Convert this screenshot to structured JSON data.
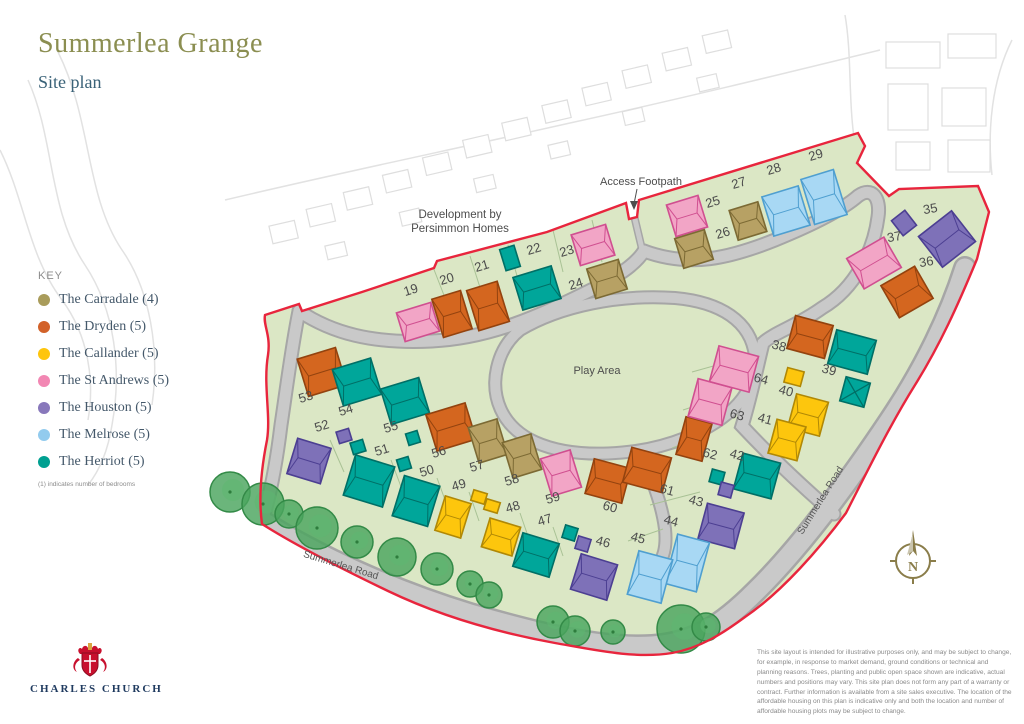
{
  "header": {
    "title": "Summerlea Grange",
    "subtitle": "Site plan"
  },
  "key": {
    "heading": "KEY",
    "note": "(1) indicates number of bedrooms",
    "items": [
      {
        "label": "The Carradale (4)",
        "color": "#a99c5b"
      },
      {
        "label": "The Dryden (5)",
        "color": "#d2622a"
      },
      {
        "label": "The Callander (5)",
        "color": "#fec50d"
      },
      {
        "label": "The St Andrews (5)",
        "color": "#f287b3"
      },
      {
        "label": "The Houston (5)",
        "color": "#8878bb"
      },
      {
        "label": "The Melrose (5)",
        "color": "#92cbee"
      },
      {
        "label": "The Herriot (5)",
        "color": "#00a091"
      }
    ]
  },
  "footer": {
    "logo": "CHARLES CHURCH",
    "disclaimer": "This site layout is intended for illustrative purposes only, and may be subject to change, for example, in response to market demand, ground conditions or technical and planning reasons. Trees, planting and public open space shown are indicative, actual numbers and positions may vary. This site plan does not form any part of a warranty or contract. Further information is available from a site sales executive. The location of the affordable housing on this plan is indicative only and both the location and number of affordable housing plots may be subject to change."
  },
  "map": {
    "labels": {
      "persimmon_line1": "Development by",
      "persimmon_line2": "Persimmon Homes",
      "access_footpath": "Access Footpath",
      "play_area": "Play Area",
      "road_bottom": "Summerlea Road",
      "road_right": "Summerlea Road"
    },
    "compass_n": "N",
    "boundary_color": "#e8253d",
    "site_green": "#dbe7c5",
    "house_colors": {
      "carradale": {
        "f": "#b7a164",
        "s": "#7c6a34"
      },
      "dryden": {
        "f": "#d4661f",
        "s": "#93430f"
      },
      "callander": {
        "f": "#fdc60d",
        "s": "#b08806"
      },
      "standrews": {
        "f": "#f2a5c6",
        "s": "#d04f90"
      },
      "houston": {
        "f": "#7e71b8",
        "s": "#4c3f92"
      },
      "melrose": {
        "f": "#a8d8f4",
        "s": "#4f9fd0"
      },
      "herriot": {
        "f": "#00a69a",
        "s": "#006f66"
      }
    },
    "plots": [
      {
        "n": "19",
        "x": 412,
        "y": 294,
        "r": -17
      },
      {
        "n": "20",
        "x": 448,
        "y": 283,
        "r": -17
      },
      {
        "n": "21",
        "x": 483,
        "y": 270,
        "r": -17
      },
      {
        "n": "22",
        "x": 535,
        "y": 253,
        "r": -17
      },
      {
        "n": "23",
        "x": 568,
        "y": 255,
        "r": -17
      },
      {
        "n": "24",
        "x": 577,
        "y": 288,
        "r": -17
      },
      {
        "n": "25",
        "x": 714,
        "y": 206,
        "r": -17
      },
      {
        "n": "26",
        "x": 724,
        "y": 237,
        "r": -17
      },
      {
        "n": "27",
        "x": 740,
        "y": 187,
        "r": -17
      },
      {
        "n": "28",
        "x": 775,
        "y": 173,
        "r": -17
      },
      {
        "n": "29",
        "x": 817,
        "y": 159,
        "r": -17
      },
      {
        "n": "35",
        "x": 931,
        "y": 213,
        "r": -10
      },
      {
        "n": "36",
        "x": 927,
        "y": 266,
        "r": -10
      },
      {
        "n": "37",
        "x": 895,
        "y": 241,
        "r": -10
      },
      {
        "n": "38",
        "x": 778,
        "y": 350,
        "r": 15
      },
      {
        "n": "39",
        "x": 828,
        "y": 374,
        "r": 15
      },
      {
        "n": "40",
        "x": 785,
        "y": 395,
        "r": 15
      },
      {
        "n": "41",
        "x": 764,
        "y": 423,
        "r": 15
      },
      {
        "n": "42",
        "x": 736,
        "y": 459,
        "r": 15
      },
      {
        "n": "43",
        "x": 695,
        "y": 505,
        "r": 15
      },
      {
        "n": "44",
        "x": 670,
        "y": 525,
        "r": 15
      },
      {
        "n": "45",
        "x": 637,
        "y": 542,
        "r": 15
      },
      {
        "n": "46",
        "x": 602,
        "y": 546,
        "r": 15
      },
      {
        "n": "47",
        "x": 546,
        "y": 524,
        "r": -17
      },
      {
        "n": "48",
        "x": 514,
        "y": 511,
        "r": -17
      },
      {
        "n": "49",
        "x": 460,
        "y": 489,
        "r": -17
      },
      {
        "n": "50",
        "x": 428,
        "y": 475,
        "r": -17
      },
      {
        "n": "51",
        "x": 383,
        "y": 454,
        "r": -17
      },
      {
        "n": "52",
        "x": 323,
        "y": 430,
        "r": -17
      },
      {
        "n": "53",
        "x": 307,
        "y": 401,
        "r": -17
      },
      {
        "n": "54",
        "x": 347,
        "y": 414,
        "r": -17
      },
      {
        "n": "55",
        "x": 392,
        "y": 431,
        "r": -17
      },
      {
        "n": "56",
        "x": 440,
        "y": 456,
        "r": -17
      },
      {
        "n": "57",
        "x": 478,
        "y": 470,
        "r": -17
      },
      {
        "n": "58",
        "x": 513,
        "y": 484,
        "r": -17
      },
      {
        "n": "59",
        "x": 554,
        "y": 502,
        "r": -17
      },
      {
        "n": "60",
        "x": 609,
        "y": 511,
        "r": 15
      },
      {
        "n": "61",
        "x": 666,
        "y": 494,
        "r": 15
      },
      {
        "n": "62",
        "x": 709,
        "y": 458,
        "r": 15
      },
      {
        "n": "63",
        "x": 736,
        "y": 419,
        "r": 15
      },
      {
        "n": "64",
        "x": 760,
        "y": 383,
        "r": 15
      }
    ],
    "houses": [
      {
        "t": "standrews",
        "x": 418,
        "y": 322,
        "w": 36,
        "h": 30,
        "r": -17
      },
      {
        "t": "dryden",
        "x": 452,
        "y": 314,
        "w": 30,
        "h": 40,
        "r": -17
      },
      {
        "t": "dryden",
        "x": 488,
        "y": 306,
        "w": 32,
        "h": 42,
        "r": -17
      },
      {
        "t": "herriot",
        "x": 537,
        "y": 288,
        "w": 40,
        "h": 34,
        "r": -17
      },
      {
        "t": "standrews",
        "x": 593,
        "y": 245,
        "w": 36,
        "h": 32,
        "r": -17
      },
      {
        "t": "carradale",
        "x": 607,
        "y": 279,
        "w": 33,
        "h": 31,
        "r": -17
      },
      {
        "t": "standrews",
        "x": 687,
        "y": 216,
        "w": 33,
        "h": 33,
        "r": -17
      },
      {
        "t": "carradale",
        "x": 694,
        "y": 249,
        "w": 31,
        "h": 31,
        "r": -17
      },
      {
        "t": "carradale",
        "x": 748,
        "y": 221,
        "w": 30,
        "h": 31,
        "r": -17
      },
      {
        "t": "melrose",
        "x": 786,
        "y": 211,
        "w": 38,
        "h": 41,
        "r": -17
      },
      {
        "t": "melrose",
        "x": 824,
        "y": 197,
        "w": 34,
        "h": 47,
        "r": -17
      },
      {
        "t": "houston",
        "x": 947,
        "y": 239,
        "w": 42,
        "h": 39,
        "r": -38
      },
      {
        "t": "dryden",
        "x": 907,
        "y": 292,
        "w": 39,
        "h": 37,
        "r": -30
      },
      {
        "t": "standrews",
        "x": 874,
        "y": 263,
        "w": 43,
        "h": 35,
        "r": -30
      },
      {
        "t": "dryden",
        "x": 810,
        "y": 337,
        "w": 39,
        "h": 34,
        "r": 15
      },
      {
        "t": "herriot",
        "x": 852,
        "y": 352,
        "w": 41,
        "h": 35,
        "r": 15
      },
      {
        "t": "callander",
        "x": 808,
        "y": 415,
        "w": 33,
        "h": 35,
        "r": 15
      },
      {
        "t": "callander",
        "x": 787,
        "y": 440,
        "w": 30,
        "h": 35,
        "r": 15
      },
      {
        "t": "herriot",
        "x": 757,
        "y": 476,
        "w": 39,
        "h": 37,
        "r": 15
      },
      {
        "t": "houston",
        "x": 721,
        "y": 526,
        "w": 38,
        "h": 37,
        "r": 15
      },
      {
        "t": "melrose",
        "x": 687,
        "y": 563,
        "w": 33,
        "h": 51,
        "r": 15
      },
      {
        "t": "melrose",
        "x": 650,
        "y": 577,
        "w": 35,
        "h": 45,
        "r": 15
      },
      {
        "t": "houston",
        "x": 594,
        "y": 577,
        "w": 38,
        "h": 37,
        "r": 17
      },
      {
        "t": "herriot",
        "x": 536,
        "y": 555,
        "w": 38,
        "h": 35,
        "r": 17
      },
      {
        "t": "callander",
        "x": 501,
        "y": 537,
        "w": 32,
        "h": 30,
        "r": 17
      },
      {
        "t": "callander",
        "x": 453,
        "y": 517,
        "w": 27,
        "h": 36,
        "r": 17
      },
      {
        "t": "herriot",
        "x": 416,
        "y": 501,
        "w": 37,
        "h": 42,
        "r": 17
      },
      {
        "t": "herriot",
        "x": 369,
        "y": 481,
        "w": 41,
        "h": 42,
        "r": 17
      },
      {
        "t": "houston",
        "x": 309,
        "y": 461,
        "w": 35,
        "h": 37,
        "r": 17
      },
      {
        "t": "dryden",
        "x": 322,
        "y": 372,
        "w": 40,
        "h": 39,
        "r": -17
      },
      {
        "t": "herriot",
        "x": 357,
        "y": 382,
        "w": 40,
        "h": 38,
        "r": -17
      },
      {
        "t": "herriot",
        "x": 405,
        "y": 401,
        "w": 40,
        "h": 37,
        "r": -17
      },
      {
        "t": "dryden",
        "x": 451,
        "y": 427,
        "w": 41,
        "h": 38,
        "r": -17
      },
      {
        "t": "carradale",
        "x": 488,
        "y": 441,
        "w": 30,
        "h": 37,
        "r": -17
      },
      {
        "t": "carradale",
        "x": 522,
        "y": 456,
        "w": 30,
        "h": 37,
        "r": -17
      },
      {
        "t": "standrews",
        "x": 561,
        "y": 473,
        "w": 31,
        "h": 39,
        "r": -17
      },
      {
        "t": "dryden",
        "x": 608,
        "y": 481,
        "w": 38,
        "h": 36,
        "r": 15
      },
      {
        "t": "dryden",
        "x": 647,
        "y": 470,
        "w": 41,
        "h": 36,
        "r": 15
      },
      {
        "t": "dryden",
        "x": 694,
        "y": 439,
        "w": 27,
        "h": 39,
        "r": 15
      },
      {
        "t": "standrews",
        "x": 710,
        "y": 402,
        "w": 35,
        "h": 39,
        "r": 15
      },
      {
        "t": "standrews",
        "x": 734,
        "y": 369,
        "w": 41,
        "h": 37,
        "r": 15
      }
    ],
    "garages": [
      {
        "t": "herriot",
        "x": 510,
        "y": 258,
        "w": 15,
        "h": 22,
        "r": -17
      },
      {
        "t": "houston",
        "x": 904,
        "y": 223,
        "w": 17,
        "h": 19,
        "r": -38
      },
      {
        "t": "callander",
        "x": 794,
        "y": 377,
        "w": 17,
        "h": 15,
        "r": 15
      },
      {
        "t": "herriot",
        "x": 855,
        "y": 392,
        "w": 25,
        "h": 25,
        "r": 15,
        "cross": true
      },
      {
        "t": "herriot",
        "x": 717,
        "y": 477,
        "w": 13,
        "h": 13,
        "r": 15
      },
      {
        "t": "houston",
        "x": 726,
        "y": 490,
        "w": 13,
        "h": 13,
        "r": 15
      },
      {
        "t": "herriot",
        "x": 570,
        "y": 533,
        "w": 13,
        "h": 13,
        "r": 17
      },
      {
        "t": "houston",
        "x": 583,
        "y": 544,
        "w": 13,
        "h": 13,
        "r": 17
      },
      {
        "t": "callander",
        "x": 479,
        "y": 497,
        "w": 14,
        "h": 11,
        "r": 17
      },
      {
        "t": "callander",
        "x": 492,
        "y": 506,
        "w": 14,
        "h": 11,
        "r": 17
      },
      {
        "t": "herriot",
        "x": 413,
        "y": 438,
        "w": 12,
        "h": 12,
        "r": -17
      },
      {
        "t": "herriot",
        "x": 404,
        "y": 464,
        "w": 12,
        "h": 12,
        "r": -17
      },
      {
        "t": "houston",
        "x": 344,
        "y": 436,
        "w": 13,
        "h": 12,
        "r": -17
      },
      {
        "t": "herriot",
        "x": 358,
        "y": 447,
        "w": 13,
        "h": 12,
        "r": -17
      }
    ],
    "trees": [
      [
        230,
        492,
        20
      ],
      [
        263,
        504,
        21
      ],
      [
        289,
        514,
        14
      ],
      [
        317,
        528,
        21
      ],
      [
        357,
        542,
        16
      ],
      [
        397,
        557,
        19
      ],
      [
        437,
        569,
        16
      ],
      [
        470,
        584,
        13
      ],
      [
        489,
        595,
        13
      ],
      [
        553,
        622,
        16
      ],
      [
        575,
        631,
        15
      ],
      [
        613,
        632,
        12
      ],
      [
        681,
        629,
        24
      ],
      [
        706,
        627,
        14
      ]
    ],
    "parcel_lines": [
      [
        433,
        267,
        447,
        303
      ],
      [
        470,
        256,
        483,
        297
      ],
      [
        508,
        245,
        520,
        286
      ],
      [
        553,
        230,
        563,
        272
      ],
      [
        592,
        220,
        602,
        262
      ],
      [
        330,
        440,
        344,
        472
      ],
      [
        391,
        460,
        403,
        492
      ],
      [
        437,
        478,
        448,
        508
      ],
      [
        469,
        492,
        479,
        521
      ],
      [
        520,
        513,
        530,
        542
      ],
      [
        553,
        527,
        563,
        556
      ],
      [
        692,
        372,
        742,
        358
      ],
      [
        683,
        410,
        720,
        398
      ],
      [
        672,
        448,
        705,
        436
      ],
      [
        650,
        505,
        700,
        492
      ],
      [
        628,
        541,
        663,
        529
      ]
    ]
  }
}
